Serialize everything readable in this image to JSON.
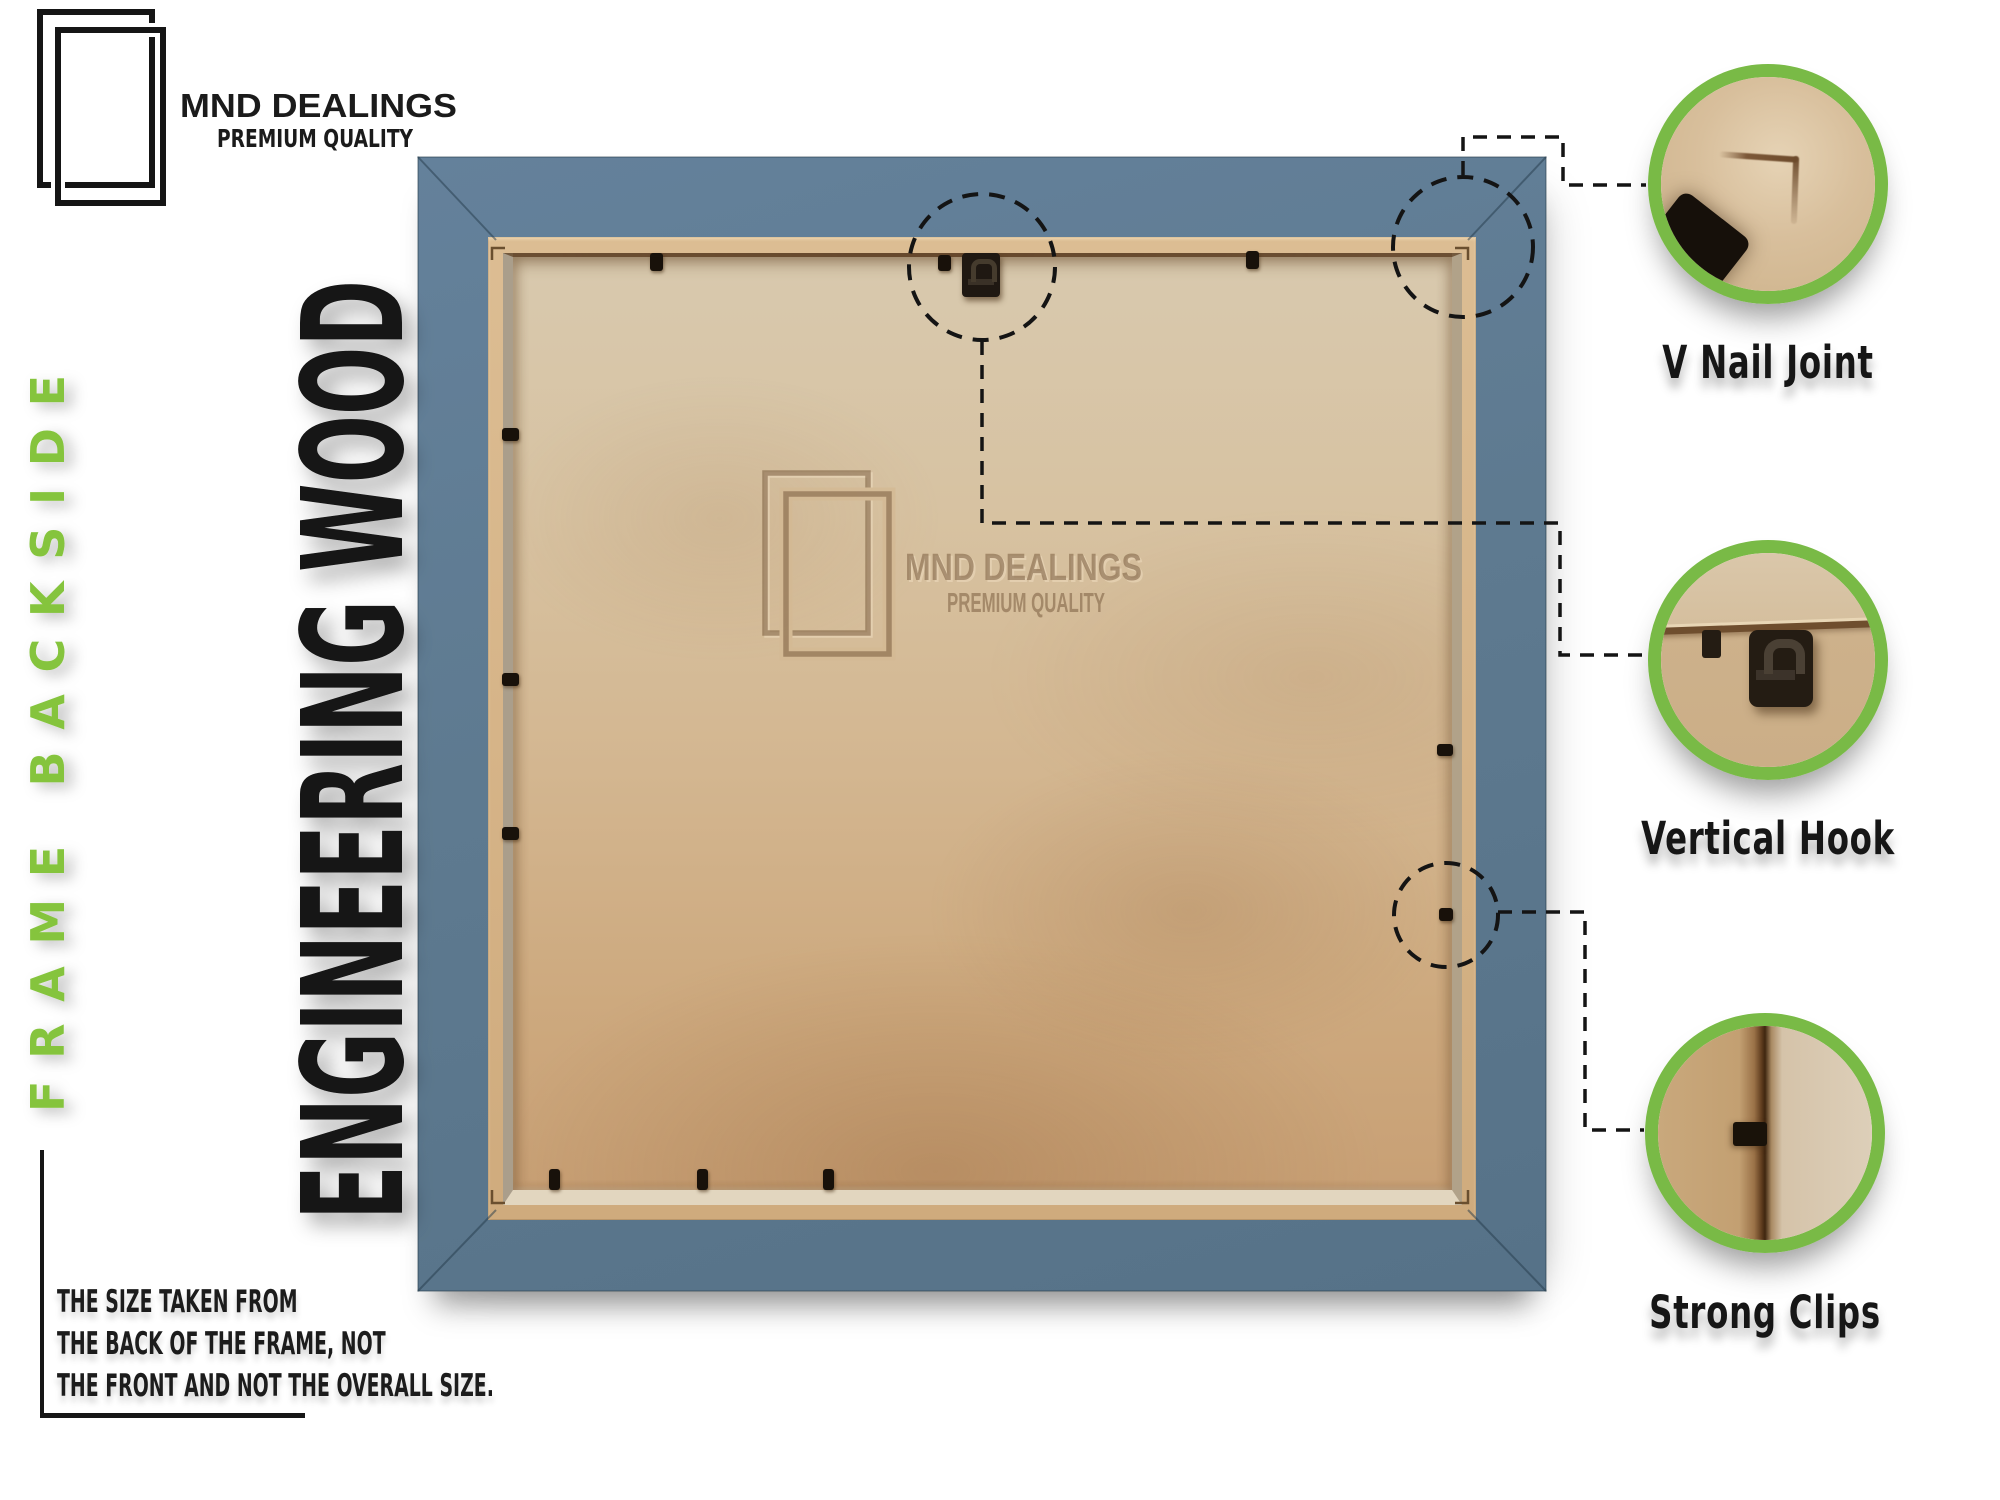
{
  "brand": {
    "name": "MND DEALINGS",
    "tagline": "PREMIUM QUALITY"
  },
  "left_rail": {
    "side_label": "FRAME BACKSIDE",
    "material_label": "ENGINEERING WOOD"
  },
  "note": {
    "lines": [
      "THE SIZE TAKEN FROM",
      "THE BACK OF THE FRAME, NOT",
      "THE FRONT AND NOT THE OVERALL SIZE."
    ]
  },
  "watermark": {
    "name": "MND DEALINGS",
    "tagline": "PREMIUM QUALITY"
  },
  "callouts": [
    {
      "label": "V Nail Joint"
    },
    {
      "label": "Vertical Hook"
    },
    {
      "label": "Strong Clips"
    }
  ],
  "colors": {
    "accent_green": "#79ba46",
    "green_text": "#85c43e",
    "frame_blue": "#5e7a8e",
    "backing_tan": "#d3b58e",
    "ink": "#151515"
  }
}
